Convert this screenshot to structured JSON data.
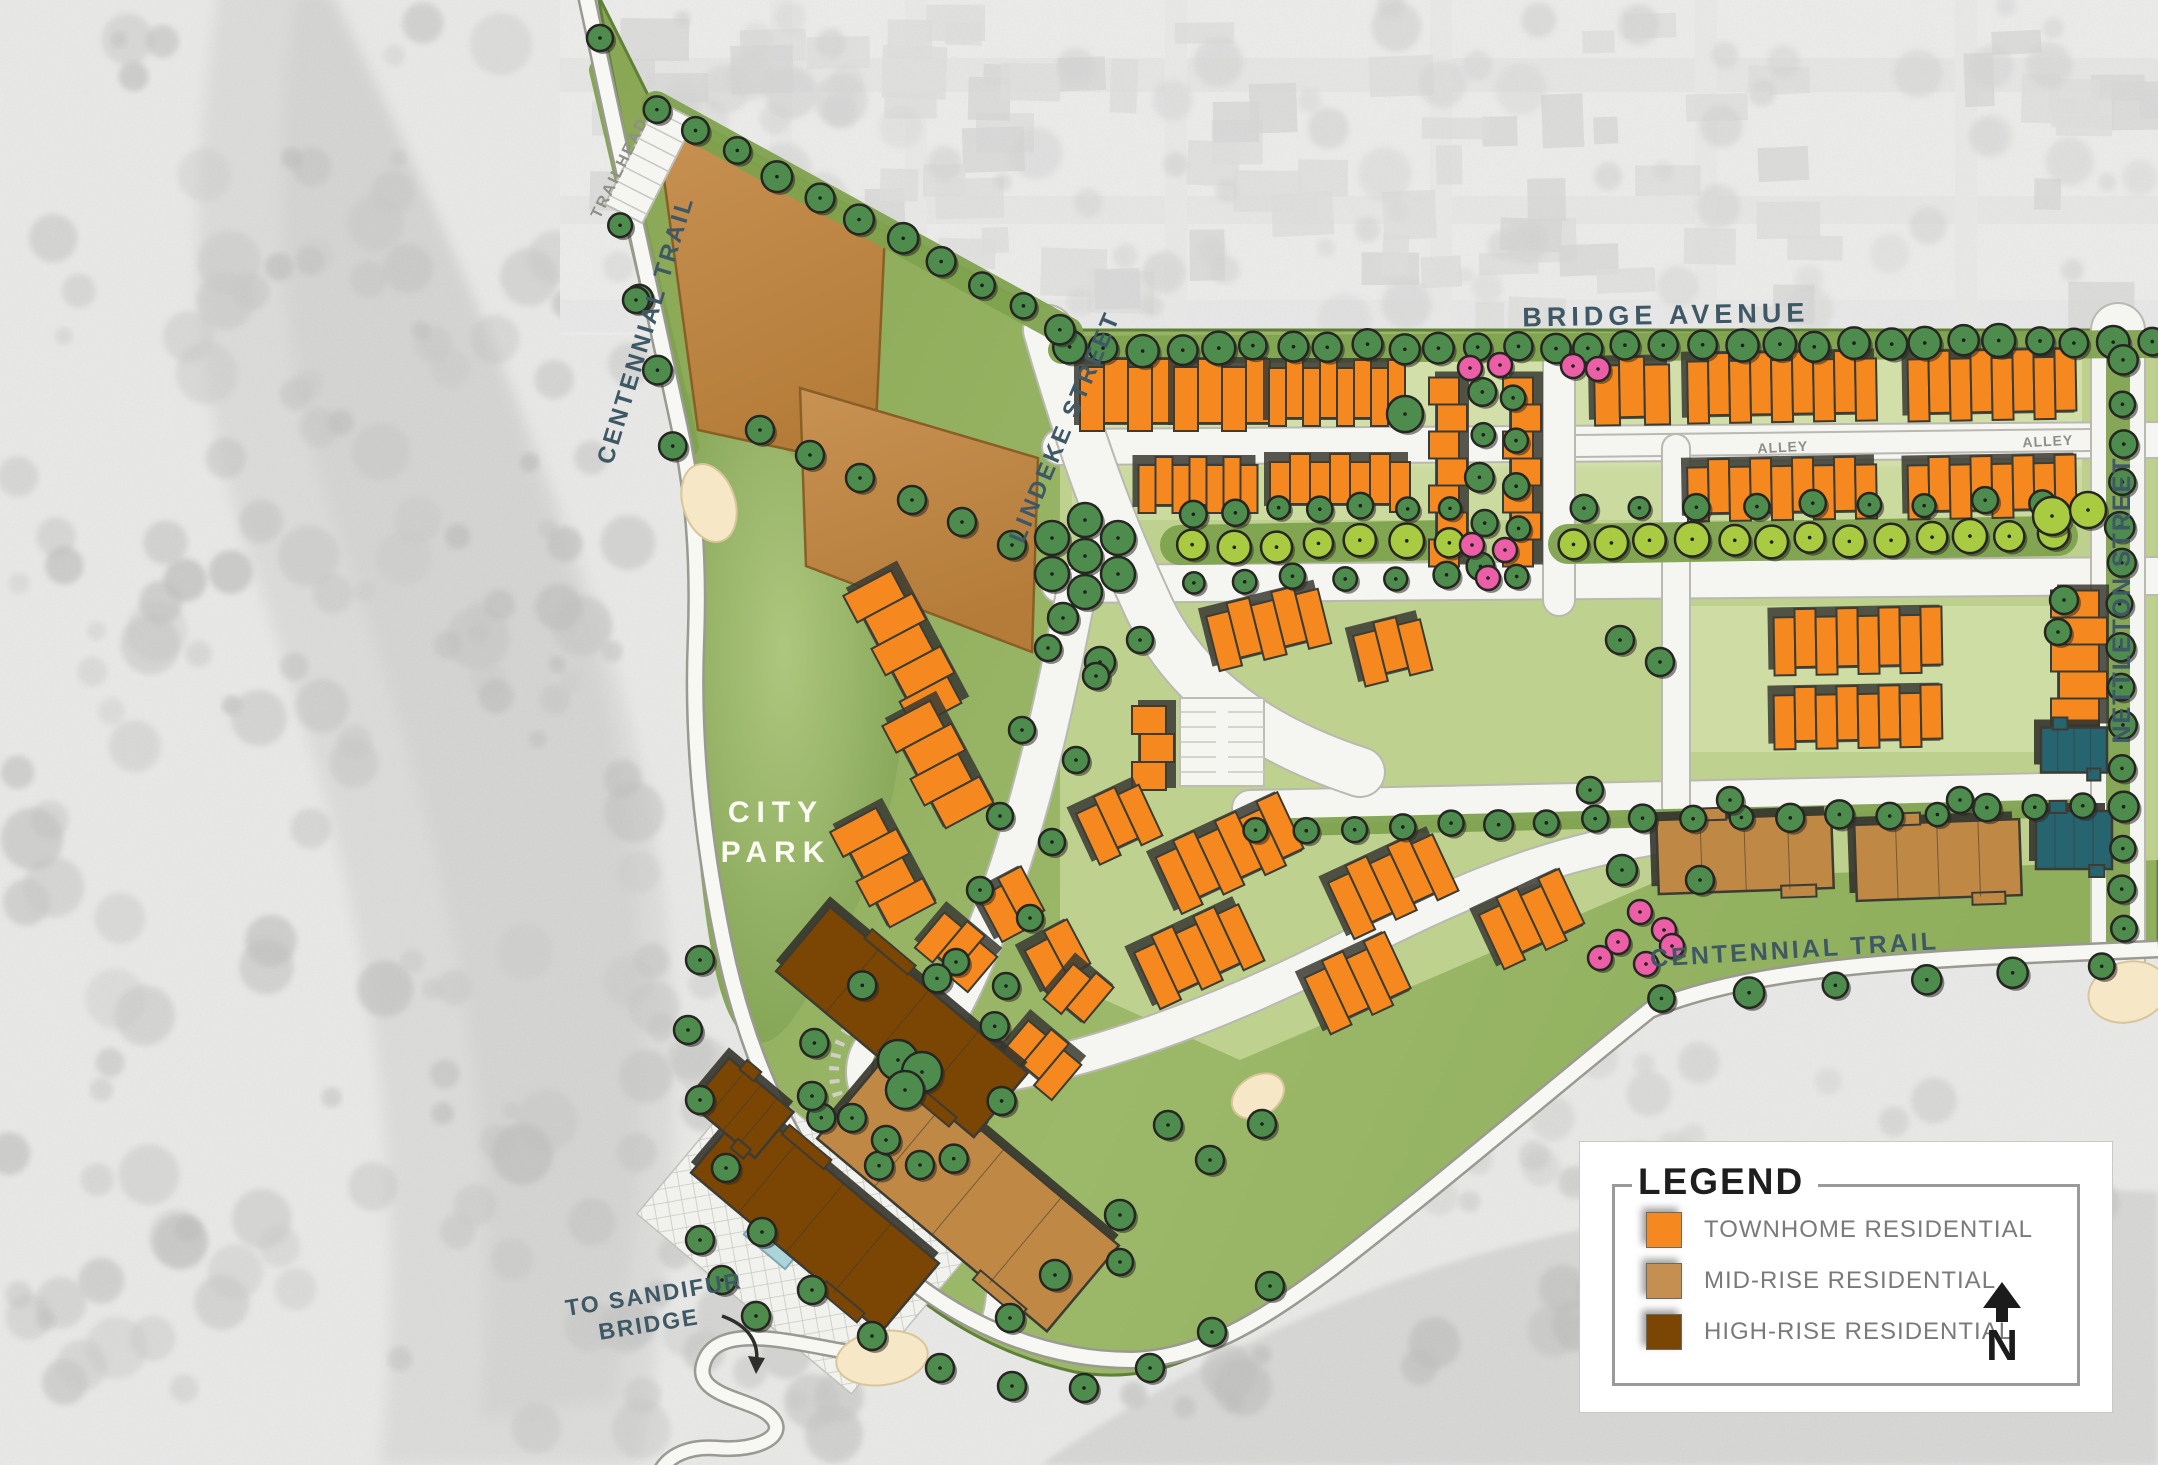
{
  "labels": {
    "bridge_avenue": {
      "text": "BRIDGE AVENUE"
    },
    "lindeke_street": {
      "text": "LINDEKE STREET"
    },
    "nettleton_street": {
      "text": "NETTLETON STREET"
    },
    "centennial_trail_west": {
      "text": "CENTENNIAL TRAIL"
    },
    "centennial_trail_south": {
      "text": "CENTENNIAL TRAIL"
    },
    "city_park_line1": {
      "text": "CITY"
    },
    "city_park_line2": {
      "text": "PARK"
    },
    "trailhead": {
      "text": "TRAILHEAD"
    },
    "alley_west": {
      "text": "ALLEY"
    },
    "alley_east": {
      "text": "ALLEY"
    },
    "to_sandifur_line1": {
      "text": "TO SANDIFUR"
    },
    "to_sandifur_line2": {
      "text": "BRIDGE"
    }
  },
  "legend": {
    "title": "LEGEND",
    "items": [
      {
        "label": "TOWNHOME RESIDENTIAL",
        "color": "#F5891F"
      },
      {
        "label": "MID-RISE RESIDENTIAL",
        "color": "#C68F52"
      },
      {
        "label": "HIGH-RISE RESIDENTIAL",
        "color": "#7B4503"
      }
    ],
    "north_label": "N"
  },
  "colors": {
    "townhome": "#F5891F",
    "midrise": "#C08845",
    "highrise": "#7B4503",
    "civic_teal": "#26646F",
    "building_outline": "#3C3C34",
    "tree_dark": "#4E8C4D",
    "tree_light": "#A9CB41",
    "tree_pink": "#EC5FA6",
    "site_green": "#94B160",
    "park_green_dark": "#7C9E4E",
    "park_green_light": "#AEC77E",
    "lawn_light": "#D6E2AE",
    "verge_green": "#7EA24E",
    "street_white": "#F5F5F2",
    "street_casing": "#B9B9B0",
    "cream": "#F6E8C6",
    "pool_blue": "#ACD4DB",
    "aerial_base": "#E8E8E7",
    "aerial_water": "#D6D6D5",
    "aerial_tree": "#C5C5C4",
    "aerial_house": "#D4D4D2",
    "label_blue": "#3E5866",
    "label_gray": "#8F8F8A"
  }
}
